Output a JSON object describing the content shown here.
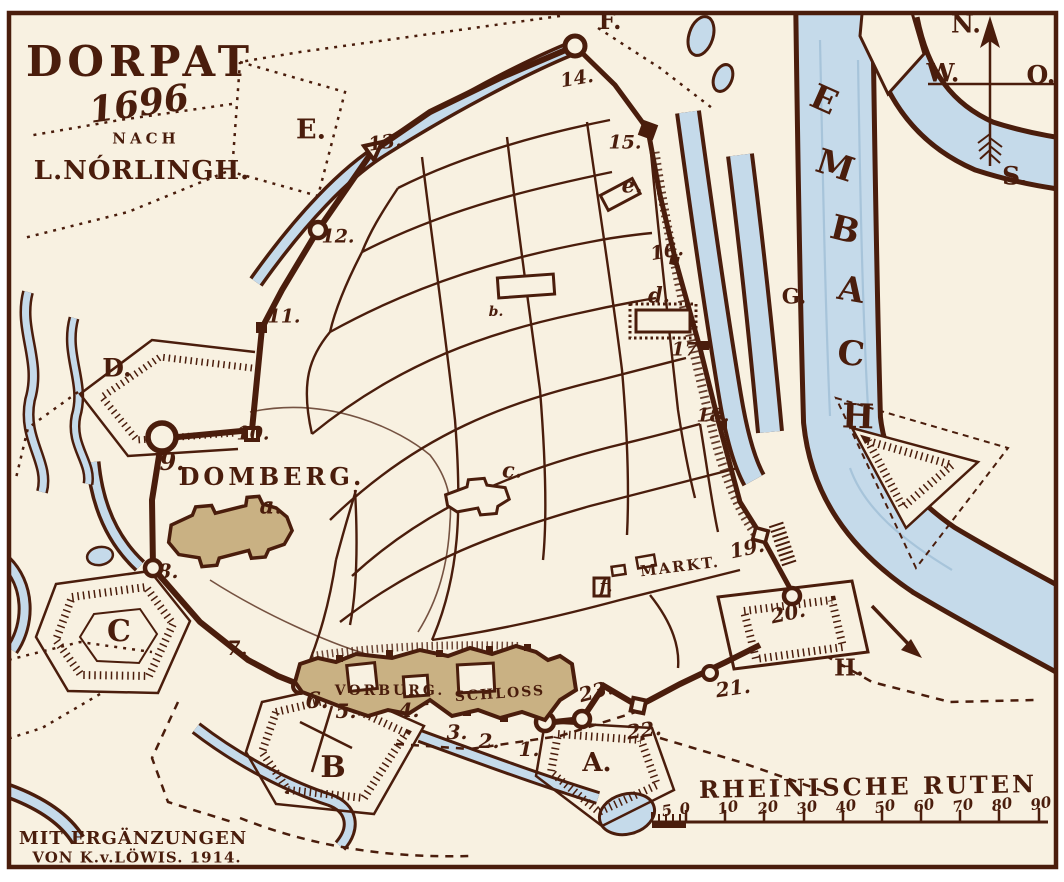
{
  "colors": {
    "paper": "#f8f1e1",
    "ink": "#4a1d0c",
    "water": "#c5daea",
    "tan": "#c9b183",
    "margin": "#ffffff"
  },
  "labels": [
    {
      "name": "map-title",
      "text": "DORPAT",
      "x": 140,
      "y": 62,
      "size": 42,
      "cls": "bold ls5"
    },
    {
      "name": "map-year",
      "text": "1696",
      "x": 139,
      "y": 104,
      "size": 36,
      "cls": "bold ital",
      "rot": -8
    },
    {
      "name": "map-subtitle-nach",
      "text": "NACH",
      "x": 146,
      "y": 139,
      "size": 15,
      "cls": "bold ls4"
    },
    {
      "name": "map-author",
      "text": "L.NÓRLINGH.",
      "x": 142,
      "y": 171,
      "size": 26,
      "cls": "bold ls1"
    },
    {
      "name": "attribution-line-1",
      "text": "MIT ERGÄNZUNGEN",
      "x": 133,
      "y": 839,
      "size": 18,
      "cls": "bold ls1"
    },
    {
      "name": "attribution-line-2",
      "text": "VON K.v.LÖWIS. 1914.",
      "x": 137,
      "y": 858,
      "size": 15,
      "cls": "bold ls1"
    },
    {
      "name": "compass-north-label",
      "text": "N.",
      "x": 966,
      "y": 24,
      "size": 25,
      "cls": "bold"
    },
    {
      "name": "compass-west-label",
      "text": "W.",
      "x": 943,
      "y": 73,
      "size": 25,
      "cls": "bold"
    },
    {
      "name": "compass-east-label",
      "text": "O.",
      "x": 1041,
      "y": 75,
      "size": 25,
      "cls": "bold"
    },
    {
      "name": "compass-south-label",
      "text": "S.",
      "x": 1015,
      "y": 176,
      "size": 25,
      "cls": "bold"
    },
    {
      "name": "river-name-letter-e",
      "text": "E",
      "x": 824,
      "y": 100,
      "size": 34,
      "cls": "bold",
      "rot": 24
    },
    {
      "name": "river-name-letter-m",
      "text": "M",
      "x": 835,
      "y": 166,
      "size": 34,
      "cls": "bold",
      "rot": 18
    },
    {
      "name": "river-name-letter-b",
      "text": "B",
      "x": 845,
      "y": 230,
      "size": 34,
      "cls": "bold",
      "rot": 14
    },
    {
      "name": "river-name-letter-a",
      "text": "A",
      "x": 851,
      "y": 290,
      "size": 34,
      "cls": "bold",
      "rot": 10
    },
    {
      "name": "river-name-letter-c",
      "text": "C",
      "x": 851,
      "y": 354,
      "size": 34,
      "cls": "bold",
      "rot": 6
    },
    {
      "name": "river-name-letter-h",
      "text": "H",
      "x": 858,
      "y": 417,
      "size": 34,
      "cls": "bold",
      "rot": 2
    },
    {
      "name": "scale-title",
      "text": "RHEINISCHE RUTEN",
      "x": 868,
      "y": 787,
      "size": 24,
      "cls": "bold ls3",
      "rot": -1
    },
    {
      "name": "scale-tick-5",
      "text": "5",
      "x": 667,
      "y": 811,
      "size": 15,
      "cls": "bold ital",
      "rot": -10
    },
    {
      "name": "scale-tick-0",
      "text": "0",
      "x": 685,
      "y": 809,
      "size": 15,
      "cls": "bold ital",
      "rot": -10
    },
    {
      "name": "scale-tick-10",
      "text": "10",
      "x": 728,
      "y": 808,
      "size": 15,
      "cls": "bold ital",
      "rot": -10
    },
    {
      "name": "scale-tick-20",
      "text": "20",
      "x": 768,
      "y": 808,
      "size": 15,
      "cls": "bold ital",
      "rot": -10
    },
    {
      "name": "scale-tick-30",
      "text": "30",
      "x": 807,
      "y": 808,
      "size": 15,
      "cls": "bold ital",
      "rot": -10
    },
    {
      "name": "scale-tick-40",
      "text": "40",
      "x": 846,
      "y": 807,
      "size": 15,
      "cls": "bold ital",
      "rot": -10
    },
    {
      "name": "scale-tick-50",
      "text": "50",
      "x": 885,
      "y": 807,
      "size": 15,
      "cls": "bold ital",
      "rot": -10
    },
    {
      "name": "scale-tick-60",
      "text": "60",
      "x": 924,
      "y": 806,
      "size": 15,
      "cls": "bold ital",
      "rot": -10
    },
    {
      "name": "scale-tick-70",
      "text": "70",
      "x": 963,
      "y": 806,
      "size": 15,
      "cls": "bold ital",
      "rot": -10
    },
    {
      "name": "scale-tick-80",
      "text": "80",
      "x": 1002,
      "y": 805,
      "size": 15,
      "cls": "bold ital",
      "rot": -10
    },
    {
      "name": "scale-tick-90",
      "text": "90",
      "x": 1041,
      "y": 804,
      "size": 15,
      "cls": "bold ital",
      "rot": -10
    },
    {
      "name": "area-label-domberg",
      "text": "DOMBERG.",
      "x": 272,
      "y": 477,
      "size": 24,
      "cls": "bold ls4"
    },
    {
      "name": "building-label-a",
      "text": "a.",
      "x": 271,
      "y": 506,
      "size": 23,
      "cls": "bold ital"
    },
    {
      "name": "area-label-vorburg",
      "text": "VORBURG.",
      "x": 390,
      "y": 691,
      "size": 14,
      "cls": "bold ls3"
    },
    {
      "name": "area-label-schloss",
      "text": "SCHLOSS",
      "x": 500,
      "y": 694,
      "size": 14,
      "cls": "bold ls2",
      "rot": -4
    },
    {
      "name": "area-label-markt",
      "text": "MARKT.",
      "x": 680,
      "y": 567,
      "size": 15,
      "cls": "bold ls2",
      "rot": -7
    },
    {
      "name": "building-label-b",
      "text": "b.",
      "x": 496,
      "y": 312,
      "size": 14,
      "cls": "bold ital"
    },
    {
      "name": "building-label-c",
      "text": "c.",
      "x": 512,
      "y": 470,
      "size": 21,
      "cls": "bold ital"
    },
    {
      "name": "building-label-d",
      "text": "d.",
      "x": 659,
      "y": 295,
      "size": 21,
      "cls": "bold ital"
    },
    {
      "name": "building-label-e",
      "text": "e.",
      "x": 632,
      "y": 185,
      "size": 21,
      "cls": "bold ital"
    },
    {
      "name": "building-label-f",
      "text": "f.",
      "x": 606,
      "y": 587,
      "size": 18,
      "cls": "bold ital"
    },
    {
      "name": "bastion-label-a",
      "text": "A.",
      "x": 597,
      "y": 763,
      "size": 26,
      "cls": "bold"
    },
    {
      "name": "bastion-label-b",
      "text": "B",
      "x": 333,
      "y": 768,
      "size": 30,
      "cls": "bold"
    },
    {
      "name": "bastion-label-c",
      "text": "C",
      "x": 119,
      "y": 632,
      "size": 30,
      "cls": "bold"
    },
    {
      "name": "bastion-label-d",
      "text": "D.",
      "x": 117,
      "y": 368,
      "size": 25,
      "cls": "bold"
    },
    {
      "name": "area-label-e-outwork",
      "text": "E.",
      "x": 311,
      "y": 130,
      "size": 27,
      "cls": "bold"
    },
    {
      "name": "area-label-f-outwork",
      "text": "F.",
      "x": 610,
      "y": 21,
      "size": 24,
      "cls": "bold"
    },
    {
      "name": "area-label-g-island",
      "text": "G.",
      "x": 794,
      "y": 296,
      "size": 21,
      "cls": "bold"
    },
    {
      "name": "bastion-label-h",
      "text": "H.",
      "x": 849,
      "y": 668,
      "size": 23,
      "cls": "bold"
    },
    {
      "name": "wall-point-1",
      "text": "1.",
      "x": 529,
      "y": 749,
      "size": 20,
      "cls": "bold ital"
    },
    {
      "name": "wall-point-2",
      "text": "2.",
      "x": 489,
      "y": 741,
      "size": 20,
      "cls": "bold ital"
    },
    {
      "name": "wall-point-3",
      "text": "3.",
      "x": 457,
      "y": 732,
      "size": 20,
      "cls": "bold ital"
    },
    {
      "name": "wall-point-4",
      "text": "4.",
      "x": 409,
      "y": 710,
      "size": 20,
      "cls": "bold ital"
    },
    {
      "name": "wall-point-5",
      "text": "5.",
      "x": 346,
      "y": 711,
      "size": 20,
      "cls": "bold ital"
    },
    {
      "name": "wall-point-6",
      "text": "6.",
      "x": 317,
      "y": 701,
      "size": 22,
      "cls": "bold ital"
    },
    {
      "name": "wall-point-7",
      "text": "7.",
      "x": 237,
      "y": 648,
      "size": 20,
      "cls": "bold ital"
    },
    {
      "name": "wall-point-8",
      "text": "8.",
      "x": 168,
      "y": 571,
      "size": 20,
      "cls": "bold ital"
    },
    {
      "name": "wall-point-9",
      "text": "9.",
      "x": 172,
      "y": 462,
      "size": 24,
      "cls": "bold ital"
    },
    {
      "name": "wall-point-10",
      "text": "10.",
      "x": 253,
      "y": 434,
      "size": 19,
      "cls": "bold ital"
    },
    {
      "name": "wall-point-11",
      "text": "11.",
      "x": 284,
      "y": 317,
      "size": 19,
      "cls": "bold ital"
    },
    {
      "name": "wall-point-12",
      "text": "12.",
      "x": 338,
      "y": 237,
      "size": 19,
      "cls": "bold ital"
    },
    {
      "name": "wall-point-13",
      "text": "13.",
      "x": 385,
      "y": 143,
      "size": 19,
      "cls": "bold ital",
      "rot": -8
    },
    {
      "name": "wall-point-14",
      "text": "14.",
      "x": 577,
      "y": 79,
      "size": 19,
      "cls": "bold ital",
      "rot": -10
    },
    {
      "name": "wall-point-15",
      "text": "15.",
      "x": 625,
      "y": 143,
      "size": 19,
      "cls": "bold ital"
    },
    {
      "name": "wall-point-16",
      "text": "16.",
      "x": 667,
      "y": 252,
      "size": 19,
      "cls": "bold ital",
      "rot": -10
    },
    {
      "name": "wall-point-17",
      "text": "17.",
      "x": 688,
      "y": 350,
      "size": 19,
      "cls": "bold ital"
    },
    {
      "name": "wall-point-18",
      "text": "18.",
      "x": 713,
      "y": 416,
      "size": 19,
      "cls": "bold ital"
    },
    {
      "name": "wall-point-19",
      "text": "19.",
      "x": 747,
      "y": 548,
      "size": 20,
      "cls": "bold ital",
      "rot": -12
    },
    {
      "name": "wall-point-20",
      "text": "20.",
      "x": 788,
      "y": 613,
      "size": 20,
      "cls": "bold ital",
      "rot": -12
    },
    {
      "name": "wall-point-21",
      "text": "21.",
      "x": 733,
      "y": 688,
      "size": 20,
      "cls": "bold ital",
      "rot": -8
    },
    {
      "name": "wall-point-22",
      "text": "22.",
      "x": 644,
      "y": 730,
      "size": 20,
      "cls": "bold ital",
      "rot": -8
    },
    {
      "name": "wall-point-23",
      "text": "23.",
      "x": 596,
      "y": 691,
      "size": 20,
      "cls": "bold ital",
      "rot": -15
    }
  ]
}
